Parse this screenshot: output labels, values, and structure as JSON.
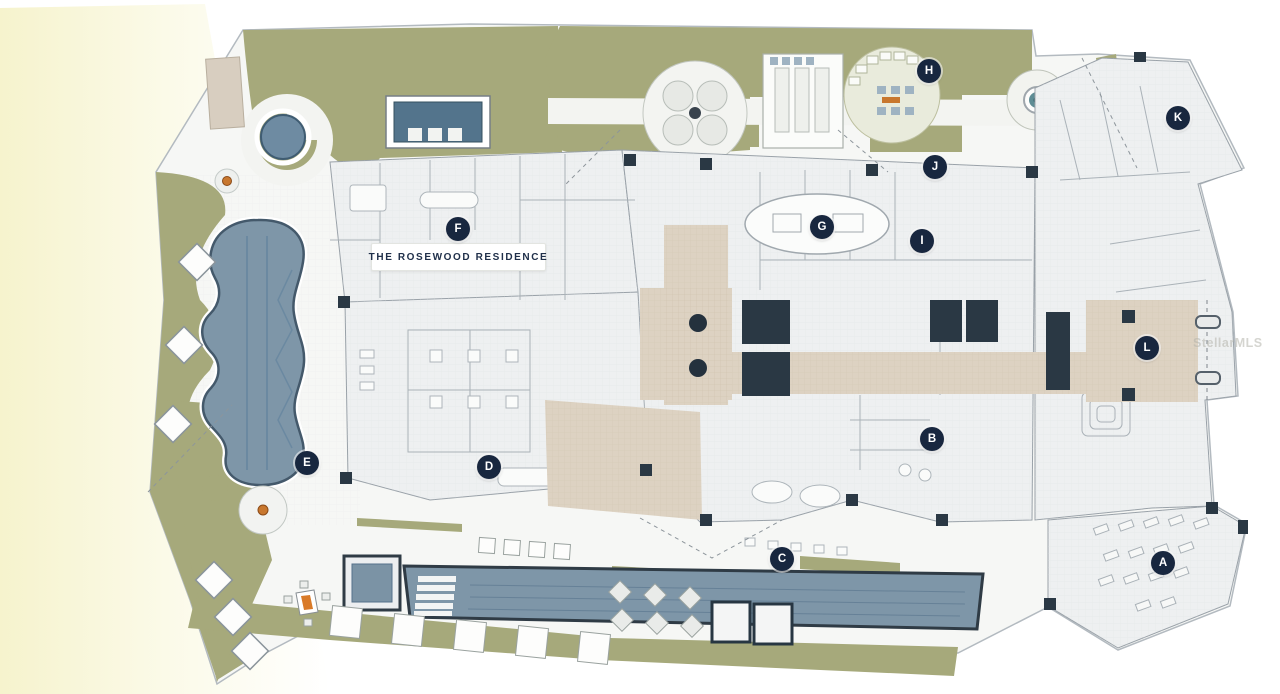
{
  "plan": {
    "title_label": "THE ROSEWOOD RESIDENCE",
    "watermark": "StellarMLS",
    "markers": [
      {
        "letter": "A",
        "x": 1163,
        "y": 563
      },
      {
        "letter": "B",
        "x": 932,
        "y": 439
      },
      {
        "letter": "C",
        "x": 782,
        "y": 559
      },
      {
        "letter": "D",
        "x": 489,
        "y": 467
      },
      {
        "letter": "E",
        "x": 307,
        "y": 463
      },
      {
        "letter": "F",
        "x": 458,
        "y": 229
      },
      {
        "letter": "G",
        "x": 822,
        "y": 227
      },
      {
        "letter": "H",
        "x": 929,
        "y": 71
      },
      {
        "letter": "I",
        "x": 922,
        "y": 241
      },
      {
        "letter": "J",
        "x": 935,
        "y": 167
      },
      {
        "letter": "K",
        "x": 1178,
        "y": 118
      },
      {
        "letter": "L",
        "x": 1147,
        "y": 348
      }
    ],
    "colors": {
      "marker_bg": "#18273f",
      "pool_water": "#7e96a8",
      "spa_water": "#6e8ba2",
      "landscape_green": "#a6a97b",
      "corridor_tan": "#ddd2c2",
      "plan_fill": "#eef0f1",
      "site_fill": "#f6f7f5",
      "wall_dark": "#2a3844",
      "accent_orange": "#c8772e",
      "highlight_yellow": "#f6f3cd",
      "watermark_gray": "#b4b4ab"
    }
  }
}
